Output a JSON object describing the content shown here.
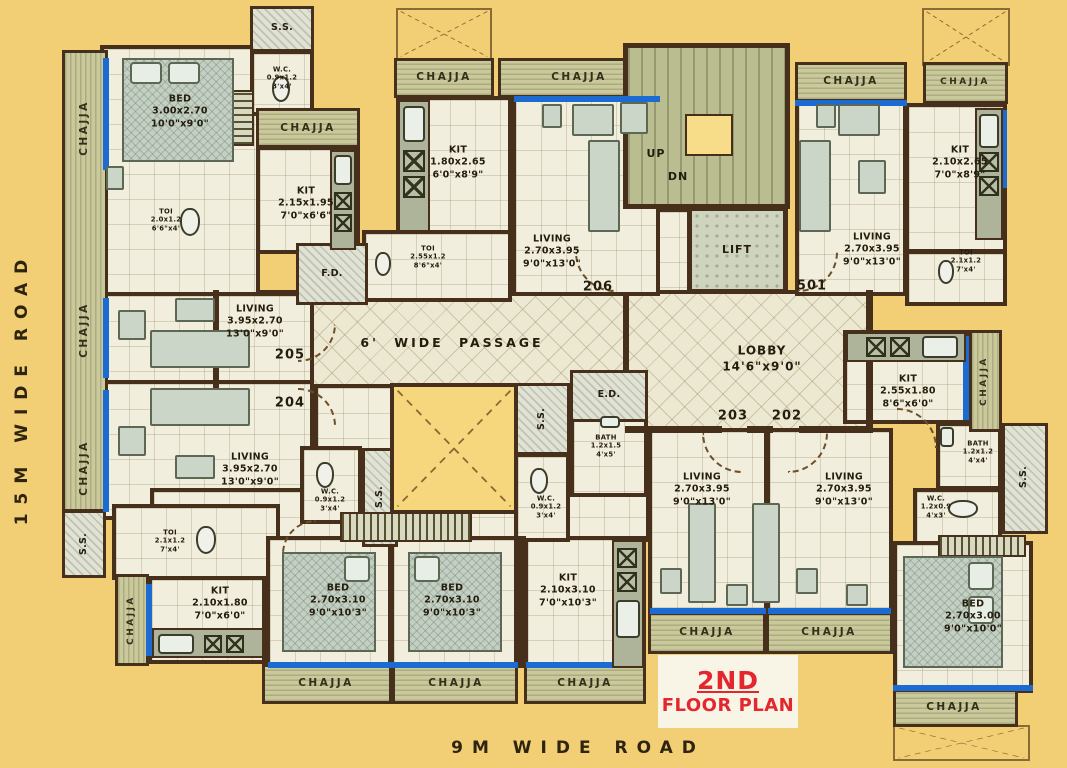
{
  "common": {
    "chajja": "CHAJJA",
    "ss": "S.S.",
    "fd": "F.D.",
    "ed": "E.D."
  },
  "roads": {
    "left": "15M WIDE ROAD",
    "bottom": "9M WIDE ROAD"
  },
  "title": {
    "line1": "2ND",
    "line2": "FLOOR PLAN"
  },
  "core": {
    "up": "UP",
    "dn": "DN",
    "lift": "LIFT",
    "passage": "6' WIDE PASSAGE",
    "lobby_name": "LOBBY",
    "lobby_dims": "14'6\"x9'0\""
  },
  "units": {
    "u501": "501",
    "u202": "202",
    "u203": "203",
    "u204": "204",
    "u205": "205",
    "u206": "206"
  },
  "rooms": {
    "bed_tl": {
      "name": "BED",
      "m": "3.00x2.70",
      "ft": "10'0\"x9'0\""
    },
    "wc_tl": {
      "name": "W.C.",
      "m": "0.9x1.2",
      "ft": "3'x4'"
    },
    "toi_tl": {
      "name": "TOI",
      "m": "2.0x1.2",
      "ft": "6'6\"x4'"
    },
    "kit_tl": {
      "name": "KIT",
      "m": "2.15x1.95",
      "ft": "7'0\"x6'6\""
    },
    "kit_206": {
      "name": "KIT",
      "m": "1.80x2.65",
      "ft": "6'0\"x8'9\""
    },
    "toi_206": {
      "name": "TOI",
      "m": "2.55x1.2",
      "ft": "8'6\"x4'"
    },
    "living_206": {
      "name": "LIVING",
      "m": "2.70x3.95",
      "ft": "9'0\"x13'0\""
    },
    "living_501": {
      "name": "LIVING",
      "m": "2.70x3.95",
      "ft": "9'0\"x13'0\""
    },
    "kit_501": {
      "name": "KIT",
      "m": "2.10x2.65",
      "ft": "7'0\"x8'9\""
    },
    "toi_501": {
      "name": "TOI",
      "m": "2.1x1.2",
      "ft": "7'x4'"
    },
    "living_205": {
      "name": "LIVING",
      "m": "3.95x2.70",
      "ft": "13'0\"x9'0\""
    },
    "living_204": {
      "name": "LIVING",
      "m": "3.95x2.70",
      "ft": "13'0\"x9'0\""
    },
    "wc_mid_left": {
      "name": "W.C.",
      "m": "0.9x1.2",
      "ft": "3'x4'"
    },
    "wc_mid_right": {
      "name": "W.C.",
      "m": "0.9x1.2",
      "ft": "3'x4'"
    },
    "bath_mid": {
      "name": "BATH",
      "m": "1.2x1.5",
      "ft": "4'x5'"
    },
    "living_203": {
      "name": "LIVING",
      "m": "2.70x3.95",
      "ft": "9'0\"x13'0\""
    },
    "living_202": {
      "name": "LIVING",
      "m": "2.70x3.95",
      "ft": "9'0\"x13'0\""
    },
    "kit_202": {
      "name": "KIT",
      "m": "2.55x1.80",
      "ft": "8'6\"x6'0\""
    },
    "bath_202": {
      "name": "BATH",
      "m": "1.2x1.2",
      "ft": "4'x4'"
    },
    "wc_202": {
      "name": "W.C.",
      "m": "1.2x0.9",
      "ft": "4'x3'"
    },
    "bed_202": {
      "name": "BED",
      "m": "2.70x3.00",
      "ft": "9'0\"x10'0\""
    },
    "toi_bl": {
      "name": "TOI",
      "m": "2.1x1.2",
      "ft": "7'x4'"
    },
    "kit_bl": {
      "name": "KIT",
      "m": "2.10x1.80",
      "ft": "7'0\"x6'0\""
    },
    "bed_b1": {
      "name": "BED",
      "m": "2.70x3.10",
      "ft": "9'0\"x10'3\""
    },
    "bed_b2": {
      "name": "BED",
      "m": "2.70x3.10",
      "ft": "9'0\"x10'3\""
    },
    "kit_b": {
      "name": "KIT",
      "m": "2.10x3.10",
      "ft": "7'0\"x10'3\""
    }
  }
}
